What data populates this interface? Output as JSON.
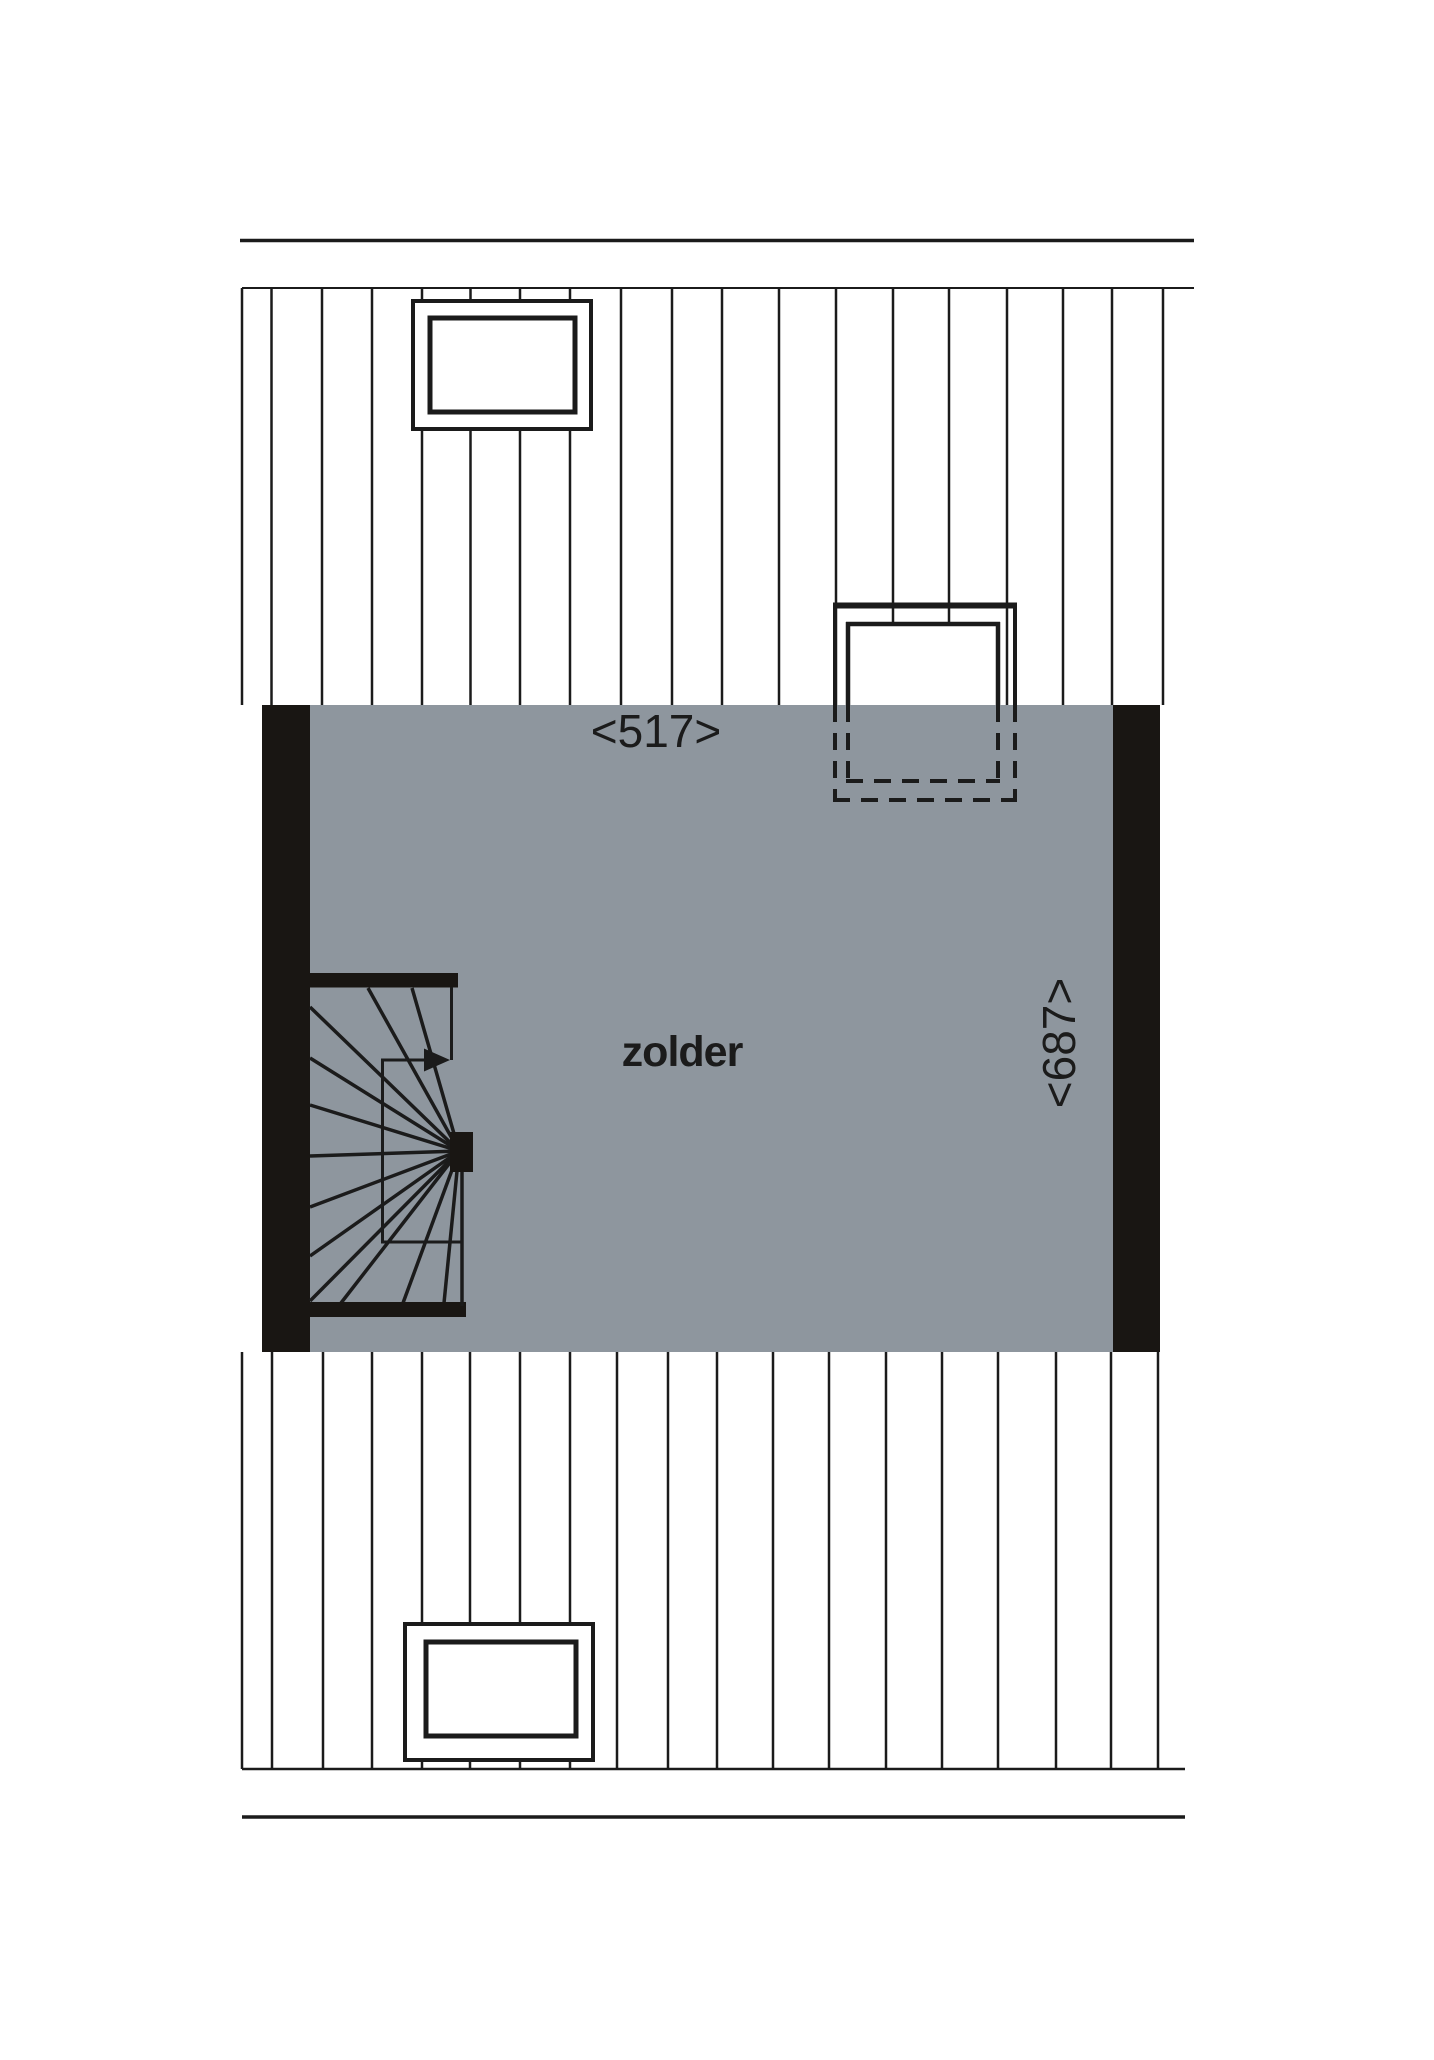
{
  "floorplan": {
    "room_label": "zolder",
    "width_dimension_label": "<517>",
    "height_dimension_label": "<687>",
    "colors": {
      "background": "#ffffff",
      "room_fill": "#8e969e",
      "wall_fill": "#191613",
      "line_color": "#1b1b1b"
    }
  }
}
